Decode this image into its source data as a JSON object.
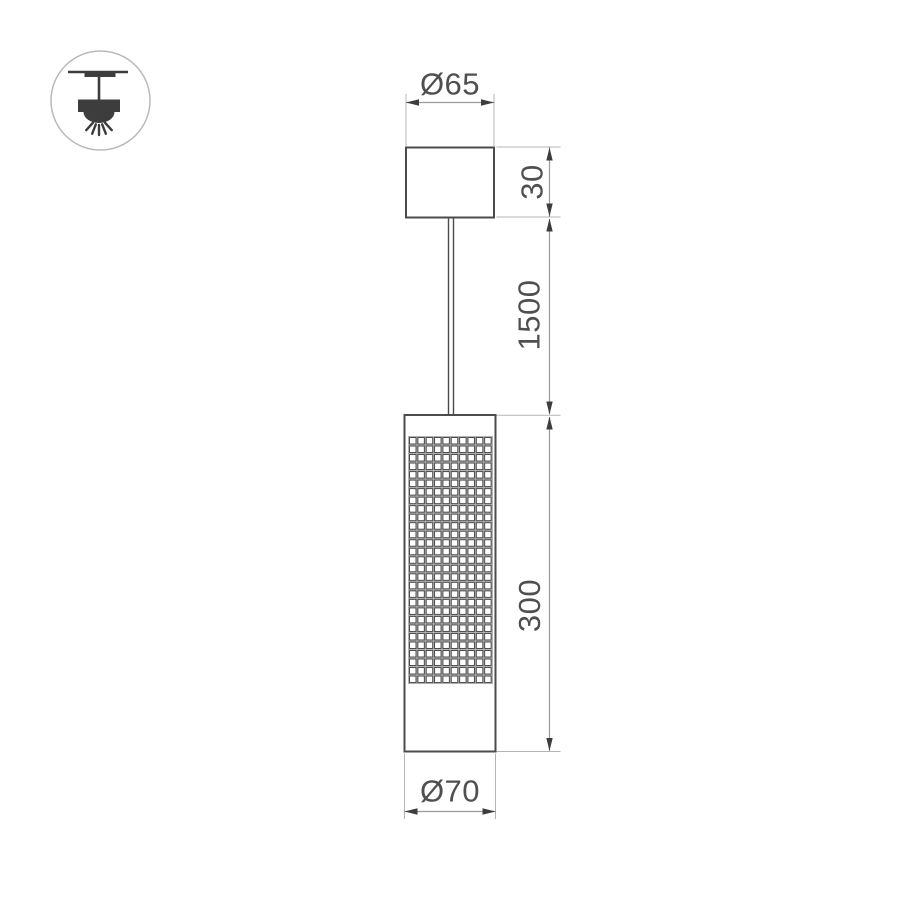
{
  "drawing": {
    "type": "pendant-luminaire-dimension-drawing",
    "dims": {
      "canopy_diameter": "Ø65",
      "canopy_height": "30",
      "suspension_length": "1500",
      "body_height": "300",
      "body_diameter": "Ø70"
    },
    "icon": {
      "symbol": "pendant-lamp-ceiling-mount",
      "rays": 5
    },
    "perforation": {
      "rows": 29,
      "cols": 10
    },
    "colors": {
      "background": "#ffffff",
      "object_stroke": "#4b4b4b",
      "dim_line": "#9a9a9a",
      "ext_line": "#b5b5b5",
      "arrow": "#3d3d3d",
      "text": "#4f4f4f",
      "grid_gap": "#b3b3b3",
      "grid_cell_stroke": "#4d4d4d",
      "grid_cell_fill": "#ffffff",
      "icon_fill": "#3d3d3d",
      "icon_circle": "#b9b9b9"
    }
  }
}
